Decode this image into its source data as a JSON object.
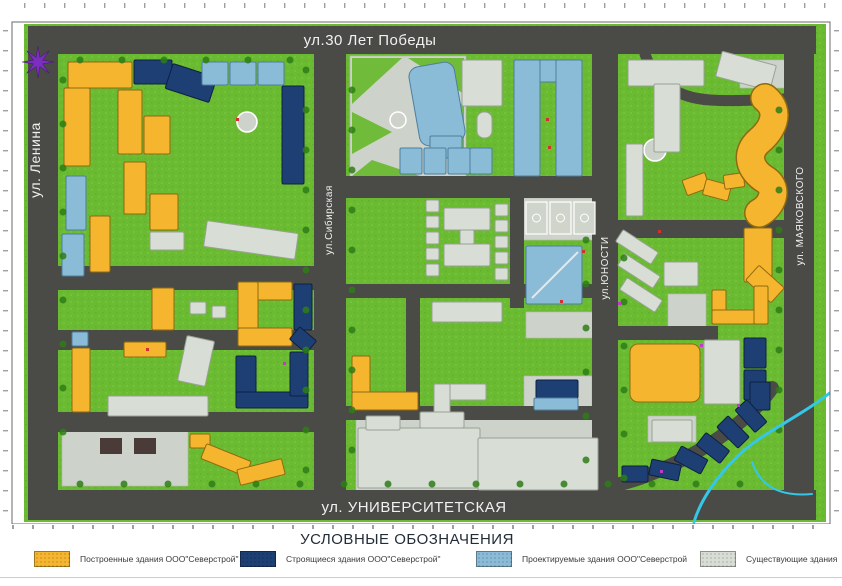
{
  "legend": {
    "title": "УСЛОВНЫЕ ОБОЗНАЧЕНИЯ",
    "items": [
      {
        "label": "Построенные здания ООО\"Северстрой\"",
        "color": "#F6B52E",
        "type": "built"
      },
      {
        "label": "Строящиеся здания ООО\"Северстрой\"",
        "color": "#1D3F74",
        "type": "under-construction"
      },
      {
        "label": "Проектируемые здания ООО\"Северстрой",
        "color": "#8ABCD8",
        "type": "projected"
      },
      {
        "label": "Существующие здания",
        "color": "#D8DED6",
        "type": "existing"
      }
    ]
  },
  "streets": [
    {
      "name": "ул.30 Лет Победы",
      "x": 370,
      "y": 45,
      "rotate": 0,
      "size": 15
    },
    {
      "name": "ул. Ленина",
      "x": 40,
      "y": 160,
      "rotate": -90,
      "size": 14
    },
    {
      "name": "ул.Сибирская",
      "x": 332,
      "y": 220,
      "rotate": -90,
      "size": 10
    },
    {
      "name": "ул.ЮНОСТИ",
      "x": 608,
      "y": 268,
      "rotate": -90,
      "size": 10
    },
    {
      "name": "ул. МАЯКОВСКОГО",
      "x": 803,
      "y": 216,
      "rotate": -90,
      "size": 10
    },
    {
      "name": "ул. УНИВЕРСИТЕТСКАЯ",
      "x": 414,
      "y": 512,
      "rotate": 0,
      "size": 15
    }
  ],
  "compass": {
    "x": 38,
    "y": 62,
    "color": "#7B2FBE"
  },
  "map": {
    "colors": {
      "green": "#6ABB31",
      "greenLight": "#79C83E",
      "road": "#4A4A47",
      "plaza": "#CDD3CA",
      "white": "#EFF1EC",
      "tree": "#2E7D18",
      "water": "#35C6E8",
      "built": "#F6B52E",
      "construction": "#1D3F74",
      "projected": "#8ABCD8",
      "existing": "#D8DED6"
    },
    "roads": [
      [
        28,
        26,
        788,
        28
      ],
      [
        28,
        490,
        788,
        30
      ],
      [
        28,
        26,
        30,
        494
      ],
      [
        784,
        26,
        30,
        494
      ],
      [
        314,
        26,
        32,
        494
      ],
      [
        592,
        54,
        26,
        466
      ],
      [
        58,
        266,
        256,
        24
      ],
      [
        58,
        330,
        256,
        20
      ],
      [
        58,
        412,
        256,
        20
      ],
      [
        346,
        176,
        246,
        22
      ],
      [
        346,
        284,
        246,
        14
      ],
      [
        346,
        406,
        246,
        14
      ],
      [
        618,
        220,
        166,
        18
      ],
      [
        618,
        326,
        100,
        14
      ],
      [
        510,
        176,
        14,
        132
      ],
      [
        406,
        284,
        14,
        126
      ]
    ],
    "road_paths": [
      {
        "d": "M645,54 C655,85 680,98 710,100 C740,102 765,99 784,99",
        "sw": 11
      },
      {
        "d": "M772,388 C748,422 700,456 640,478 C625,483 610,487 598,488",
        "sw": 14
      }
    ],
    "plazas": [
      [
        350,
        56,
        116,
        122
      ],
      [
        740,
        60,
        50,
        28
      ],
      [
        520,
        198,
        78,
        42
      ],
      [
        526,
        312,
        72,
        26
      ],
      [
        668,
        294,
        38,
        34
      ],
      [
        648,
        416,
        48,
        26
      ],
      [
        524,
        376,
        68,
        44
      ],
      [
        356,
        414,
        244,
        78
      ],
      [
        62,
        430,
        126,
        56
      ]
    ],
    "park_greens": [
      "352,58 402,58 352,104",
      "408,58 464,58 464,94",
      "352,112 392,132 352,154",
      "424,124 464,102 464,162",
      "372,160 420,176 352,176"
    ],
    "circles": [
      [
        247,
        122,
        10
      ],
      [
        655,
        150,
        11
      ],
      [
        398,
        120,
        8
      ]
    ],
    "courts": [
      [
        526,
        202,
        21,
        32
      ],
      [
        550,
        202,
        21,
        32
      ],
      [
        574,
        202,
        21,
        32
      ]
    ],
    "white_lines": [
      "M365,455 L470,455",
      "M490,462 L590,462",
      "M420,430 L420,486"
    ],
    "buildings": [
      [
        "b",
        68,
        62,
        64,
        26
      ],
      [
        "b",
        64,
        88,
        26,
        78
      ],
      [
        "c",
        134,
        60,
        38,
        24
      ],
      [
        "c",
        168,
        70,
        46,
        26,
        18
      ],
      [
        "p",
        202,
        62,
        26,
        23
      ],
      [
        "p",
        230,
        62,
        26,
        23
      ],
      [
        "p",
        258,
        62,
        26,
        23
      ],
      [
        "c",
        282,
        86,
        22,
        98
      ],
      [
        "b",
        118,
        90,
        24,
        64
      ],
      [
        "b",
        144,
        116,
        26,
        38
      ],
      [
        "b",
        124,
        162,
        22,
        52
      ],
      [
        "b",
        150,
        194,
        28,
        36
      ],
      [
        "p",
        66,
        176,
        20,
        54
      ],
      [
        "p",
        62,
        234,
        22,
        42
      ],
      [
        "b",
        90,
        216,
        20,
        56
      ],
      [
        "e",
        205,
        227,
        92,
        26,
        8
      ],
      [
        "e",
        150,
        232,
        34,
        18
      ],
      [
        "b",
        238,
        282,
        54,
        18
      ],
      [
        "b",
        238,
        282,
        20,
        64
      ],
      [
        "b",
        238,
        328,
        54,
        18
      ],
      [
        "c",
        294,
        284,
        18,
        46
      ],
      [
        "c",
        292,
        332,
        22,
        16,
        40
      ],
      [
        "c",
        236,
        356,
        20,
        50
      ],
      [
        "c",
        236,
        392,
        72,
        16
      ],
      [
        "c",
        290,
        352,
        18,
        44
      ],
      [
        "b",
        152,
        288,
        22,
        42
      ],
      [
        "e",
        190,
        302,
        16,
        12
      ],
      [
        "e",
        212,
        306,
        14,
        12
      ],
      [
        "p",
        72,
        332,
        16,
        14
      ],
      [
        "b",
        72,
        348,
        18,
        64
      ],
      [
        "b",
        124,
        342,
        42,
        15
      ],
      [
        "e",
        182,
        338,
        28,
        46,
        12
      ],
      [
        "e",
        108,
        396,
        100,
        20
      ],
      [
        "b",
        190,
        434,
        20,
        14
      ],
      [
        "b",
        202,
        452,
        48,
        16,
        22
      ],
      [
        "b",
        238,
        464,
        46,
        16,
        -14
      ],
      [
        "p",
        414,
        64,
        46,
        80,
        -10,
        10
      ],
      [
        "p",
        430,
        136,
        32,
        22
      ],
      [
        "e",
        462,
        60,
        40,
        46
      ],
      [
        "p",
        514,
        60,
        68,
        22
      ],
      [
        "p",
        514,
        60,
        26,
        116
      ],
      [
        "p",
        556,
        60,
        26,
        116
      ],
      [
        "p",
        400,
        148,
        22,
        26
      ],
      [
        "p",
        424,
        148,
        22,
        26
      ],
      [
        "p",
        448,
        148,
        22,
        26
      ],
      [
        "p",
        470,
        148,
        22,
        26
      ],
      [
        "e",
        477,
        112,
        15,
        26,
        0,
        7
      ],
      [
        "e",
        426,
        200,
        13,
        12
      ],
      [
        "e",
        426,
        216,
        13,
        12
      ],
      [
        "e",
        426,
        232,
        13,
        12
      ],
      [
        "e",
        426,
        248,
        13,
        12
      ],
      [
        "e",
        426,
        264,
        13,
        12
      ],
      [
        "e",
        444,
        208,
        46,
        22
      ],
      [
        "e",
        444,
        244,
        46,
        22
      ],
      [
        "e",
        460,
        230,
        14,
        14
      ],
      [
        "e",
        495,
        204,
        13,
        12
      ],
      [
        "e",
        495,
        220,
        13,
        12
      ],
      [
        "e",
        495,
        236,
        13,
        12
      ],
      [
        "e",
        495,
        252,
        13,
        12
      ],
      [
        "e",
        495,
        268,
        13,
        12
      ],
      [
        "p",
        526,
        246,
        56,
        58
      ],
      [
        "e",
        432,
        302,
        70,
        20
      ],
      [
        "b",
        352,
        356,
        18,
        54
      ],
      [
        "b",
        352,
        392,
        66,
        18
      ],
      [
        "e",
        434,
        384,
        52,
        16
      ],
      [
        "e",
        434,
        384,
        16,
        34
      ],
      [
        "c",
        536,
        380,
        42,
        18
      ],
      [
        "p",
        534,
        398,
        44,
        12
      ],
      [
        "e",
        358,
        428,
        122,
        60
      ],
      [
        "e",
        478,
        438,
        120,
        52
      ],
      [
        "e",
        366,
        416,
        34,
        14
      ],
      [
        "e",
        420,
        412,
        44,
        16
      ],
      [
        "e",
        628,
        60,
        76,
        26
      ],
      [
        "e",
        654,
        84,
        26,
        68
      ],
      [
        "e",
        718,
        58,
        56,
        26,
        15
      ],
      [
        "b",
        684,
        176,
        24,
        16,
        -20
      ],
      [
        "b",
        704,
        182,
        26,
        16,
        15
      ],
      [
        "b",
        724,
        174,
        20,
        14,
        -8
      ],
      [
        "e",
        626,
        144,
        17,
        72
      ],
      [
        "e",
        616,
        240,
        42,
        14,
        33
      ],
      [
        "e",
        618,
        264,
        42,
        14,
        33
      ],
      [
        "e",
        620,
        288,
        42,
        14,
        33
      ],
      [
        "b",
        744,
        228,
        28,
        54
      ],
      [
        "b",
        748,
        274,
        34,
        20,
        42
      ],
      [
        "b",
        712,
        290,
        14,
        34
      ],
      [
        "b",
        712,
        310,
        56,
        14
      ],
      [
        "b",
        754,
        286,
        14,
        38
      ],
      [
        "e",
        664,
        262,
        34,
        24
      ],
      [
        "b",
        630,
        344,
        70,
        58,
        0,
        8
      ],
      [
        "e",
        704,
        340,
        36,
        64
      ],
      [
        "c",
        744,
        338,
        22,
        30
      ],
      [
        "c",
        744,
        370,
        22,
        30
      ],
      [
        "c",
        750,
        382,
        20,
        28
      ],
      [
        "c",
        736,
        408,
        30,
        16,
        48
      ],
      [
        "c",
        718,
        424,
        30,
        16,
        45
      ],
      [
        "c",
        698,
        440,
        30,
        16,
        38
      ],
      [
        "c",
        676,
        452,
        30,
        16,
        28
      ],
      [
        "c",
        650,
        462,
        30,
        16,
        12
      ],
      [
        "c",
        622,
        466,
        26,
        16
      ],
      [
        "e",
        652,
        420,
        40,
        22
      ]
    ],
    "snake": "M765,98 C782,112 772,130 759,141 C745,153 749,170 766,180 C779,189 772,206 759,213",
    "streams": [
      {
        "d": "M836,388 C800,418 762,432 738,456 C715,478 700,502 694,522",
        "sw": 3
      },
      {
        "d": "M752,462 C760,486 780,497 812,494",
        "sw": 2
      }
    ],
    "parking_marks": [
      [
        100,
        438,
        22,
        16
      ],
      [
        134,
        438,
        22,
        16
      ]
    ]
  }
}
